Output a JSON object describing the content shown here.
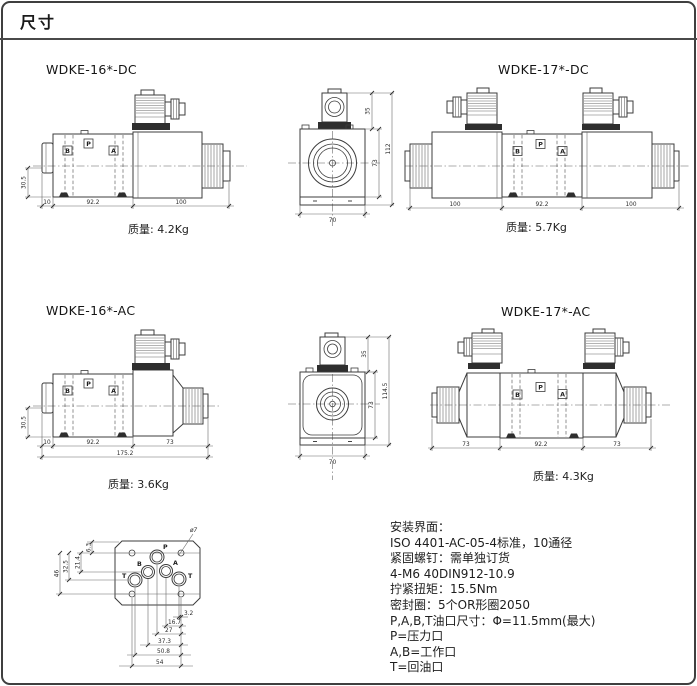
{
  "page": {
    "title": "尺寸"
  },
  "drawings": {
    "dc16": {
      "title": "WDKE-16*-DC",
      "weight": "质量: 4.2Kg",
      "ports": {
        "b": "B",
        "p": "P",
        "a": "A"
      },
      "dims": {
        "h": "30.5",
        "d1": "10",
        "d2": "92.2",
        "d3": "100"
      }
    },
    "dc_end": {
      "dims": {
        "top": "35",
        "mid": "73",
        "total": "112",
        "w": "70"
      }
    },
    "dc17": {
      "title": "WDKE-17*-DC",
      "weight": "质量: 5.7Kg",
      "ports": {
        "b": "B",
        "p": "P",
        "a": "A"
      },
      "dims": {
        "d1": "100",
        "d2": "92.2",
        "d3": "100"
      }
    },
    "ac16": {
      "title": "WDKE-16*-AC",
      "weight": "质量: 3.6Kg",
      "ports": {
        "b": "B",
        "p": "P",
        "a": "A"
      },
      "dims": {
        "h": "30.5",
        "d1": "10",
        "d2": "92.2",
        "d3": "73",
        "total": "175.2"
      }
    },
    "ac_end": {
      "dims": {
        "top": "35",
        "mid": "73",
        "total": "114.5",
        "w": "70"
      }
    },
    "ac17": {
      "title": "WDKE-17*-AC",
      "weight": "质量: 4.3Kg",
      "ports": {
        "b": "B",
        "p": "P",
        "a": "A"
      },
      "dims": {
        "d1": "73",
        "d2": "92.2",
        "d3": "73"
      }
    },
    "iface": {
      "hole": "ø7",
      "ports": {
        "p": "P",
        "b": "B",
        "a": "A",
        "t1": "T",
        "t2": "T"
      },
      "dims": {
        "v1": "6.3",
        "v2": "21.4",
        "v3": "32.5",
        "v4": "46",
        "h1": "3.2",
        "h2": "16.7",
        "h3": "27",
        "h4": "37.3",
        "h5": "50.8",
        "h6": "54"
      }
    }
  },
  "notes": {
    "lines": [
      "安装界面：",
      "ISO 4401-AC-05-4标准，10通径",
      "紧固螺钉：需单独订货",
      "4-M6 40DIN912-10.9",
      "拧紧扭矩：15.5Nm",
      "密封圈：5个OR形圈2050",
      "P,A,B,T油口尺寸：Φ=11.5mm(最大)",
      "P=压力口",
      "A,B=工作口",
      "T=回油口"
    ]
  }
}
